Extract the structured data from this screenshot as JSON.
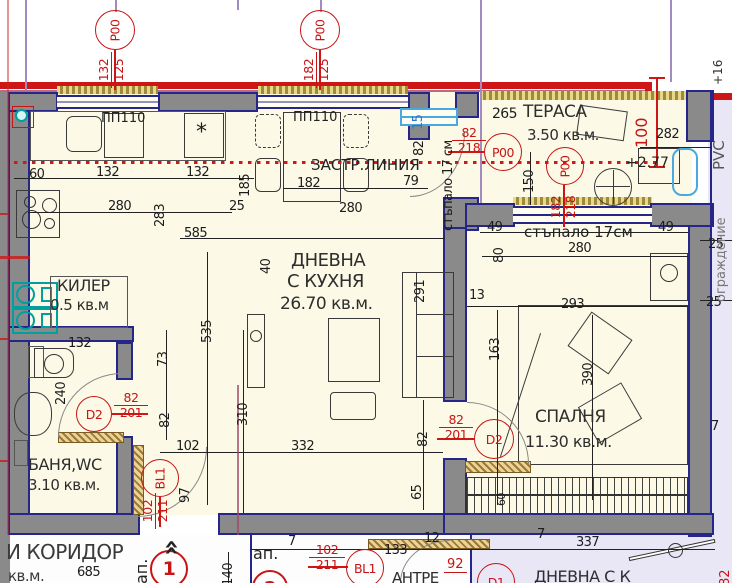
{
  "colors": {
    "accent_red": "#c71414",
    "wall_gray": "#8a8a8a",
    "navy": "#26268a",
    "cream": "#fcfae7",
    "lavender": "#e9e7f6",
    "teal": "#00a0a0",
    "window_blue": "#4aa8e0"
  },
  "axis": {
    "m1": {
      "label": "P00",
      "top": "132",
      "bot": "125"
    },
    "m2": {
      "label": "P00",
      "top": "182",
      "bot": "125"
    }
  },
  "rooms": {
    "living": {
      "l1": "ДНЕВНА",
      "l2": "С КУХНЯ",
      "area": "26.70 кв.м."
    },
    "kiler": {
      "name": "КИЛЕР",
      "area": "0.5 кв.м"
    },
    "bath": {
      "name": "БАНЯ,WC",
      "area": "3.10 кв.м."
    },
    "bedroom": {
      "name": "СПАЛНЯ",
      "area": "11.30 кв.м."
    },
    "terrace": {
      "prefix": "265",
      "name": "ТЕРАСА",
      "area": "3.50 кв.м."
    },
    "corridor": {
      "name": "И КОРИДОР",
      "unit": "кв.м."
    },
    "antre": {
      "name": "АНТРЕ"
    },
    "neighbor": {
      "name": "ДНЕВНА С К"
    }
  },
  "texts": {
    "zastr": "ЗАСТР.ЛИНИЯ",
    "step_v": "стъпало 17 см",
    "step_h": "стъпало 17см",
    "pvc": "PVC",
    "pvc2": "ограждение",
    "level": "+2.77",
    "level2": "+16",
    "pp110": "ПП110",
    "ap": "ап.",
    "entry_arrow": "»",
    "fridge_star": "*"
  },
  "doors": {
    "d2": "D2",
    "bl1": "BL1",
    "d1": "D1",
    "p00": "P00"
  },
  "apartments": {
    "ap1": "1",
    "ap2": "2"
  },
  "red": {
    "f82218": {
      "a": "82",
      "b": "218"
    },
    "f182218": {
      "a": "182",
      "b": "218"
    },
    "f82201": {
      "a": "82",
      "b": "201"
    },
    "f102211": {
      "a": "102",
      "b": "211"
    },
    "n92": "92",
    "n82": "82",
    "n100": "100"
  },
  "dims": [
    "60",
    "132",
    "132",
    "185",
    "182",
    "79",
    "280",
    "283",
    "25",
    "585",
    "280",
    "40",
    "535",
    "73",
    "132",
    "240",
    "82",
    "102",
    "97",
    "310",
    "332",
    "82",
    "65",
    "291",
    "15",
    "82",
    "150",
    "49",
    "49",
    "80",
    "280",
    "13",
    "293",
    "163",
    "390",
    "25",
    "25",
    "7",
    "282",
    "140",
    "7",
    "337",
    "133",
    "12",
    "7",
    "685",
    "60"
  ]
}
